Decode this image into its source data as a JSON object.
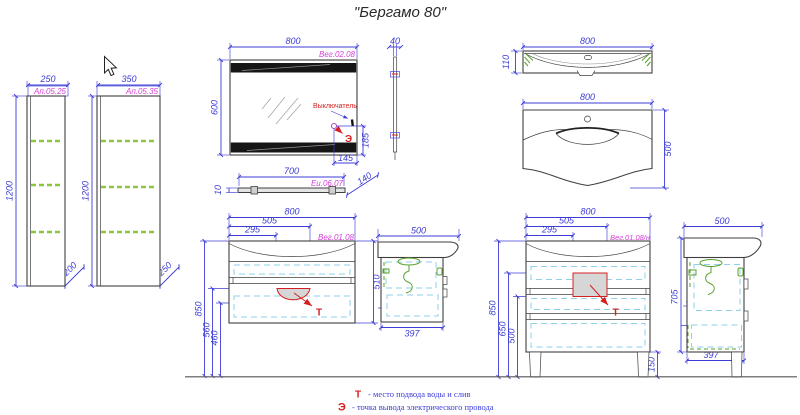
{
  "title": "\"Бергамо 80\"",
  "colors": {
    "dimension_blue": "#3c3cd6",
    "code_pink": "#d63fd6",
    "outline": "#3f3f3f",
    "shelf_green": "#8dc63f",
    "drawer_cyan": "#8ed0e8",
    "fitting_green": "#5aa02c",
    "accent_red": "#d42020"
  },
  "views": {
    "column_250": {
      "code": "Ап.05.25",
      "width": "250",
      "height": "1200",
      "depth": "200"
    },
    "column_350": {
      "code": "Ап.05.35",
      "width": "350",
      "height": "1200",
      "depth": "250"
    },
    "mirror": {
      "code": "Вег.02.08",
      "width": "800",
      "height": "600",
      "depth": "40",
      "switch_label": "Выключатель",
      "socket_height": "185",
      "socket_offset": "145",
      "socket_symbol": "Э"
    },
    "shelf": {
      "code": "Еи.06.07",
      "width": "700",
      "thickness": "10",
      "depth": "140"
    },
    "basin_top": {
      "width": "800",
      "depth": "110"
    },
    "basin_front": {
      "width": "800",
      "height": "500"
    },
    "vanity_wall": {
      "code": "Вег.01.08",
      "width": "800",
      "drain_x": "505",
      "drain_x2": "295",
      "height": "510",
      "top_height": "850",
      "drain_h1": "560",
      "drain_h2": "460",
      "symbol": "Т"
    },
    "vanity_wall_side": {
      "width": "500",
      "depth": "397",
      "gap": "36"
    },
    "vanity_floor": {
      "code": "Вег.01.08/н",
      "width": "800",
      "drain_x": "505",
      "drain_x2": "295",
      "top_height": "850",
      "drain_h1": "650",
      "drain_h2": "500",
      "leg_height": "150",
      "symbol": "Т"
    },
    "vanity_floor_side": {
      "width": "500",
      "height": "705",
      "shelf_gap": "88",
      "gap": "36",
      "depth": "397"
    }
  },
  "legend": {
    "water_symbol": "Т",
    "water_text": "- место подвода воды и слив",
    "electric_symbol": "Э",
    "electric_text": "- точка вывода электрического провода"
  }
}
